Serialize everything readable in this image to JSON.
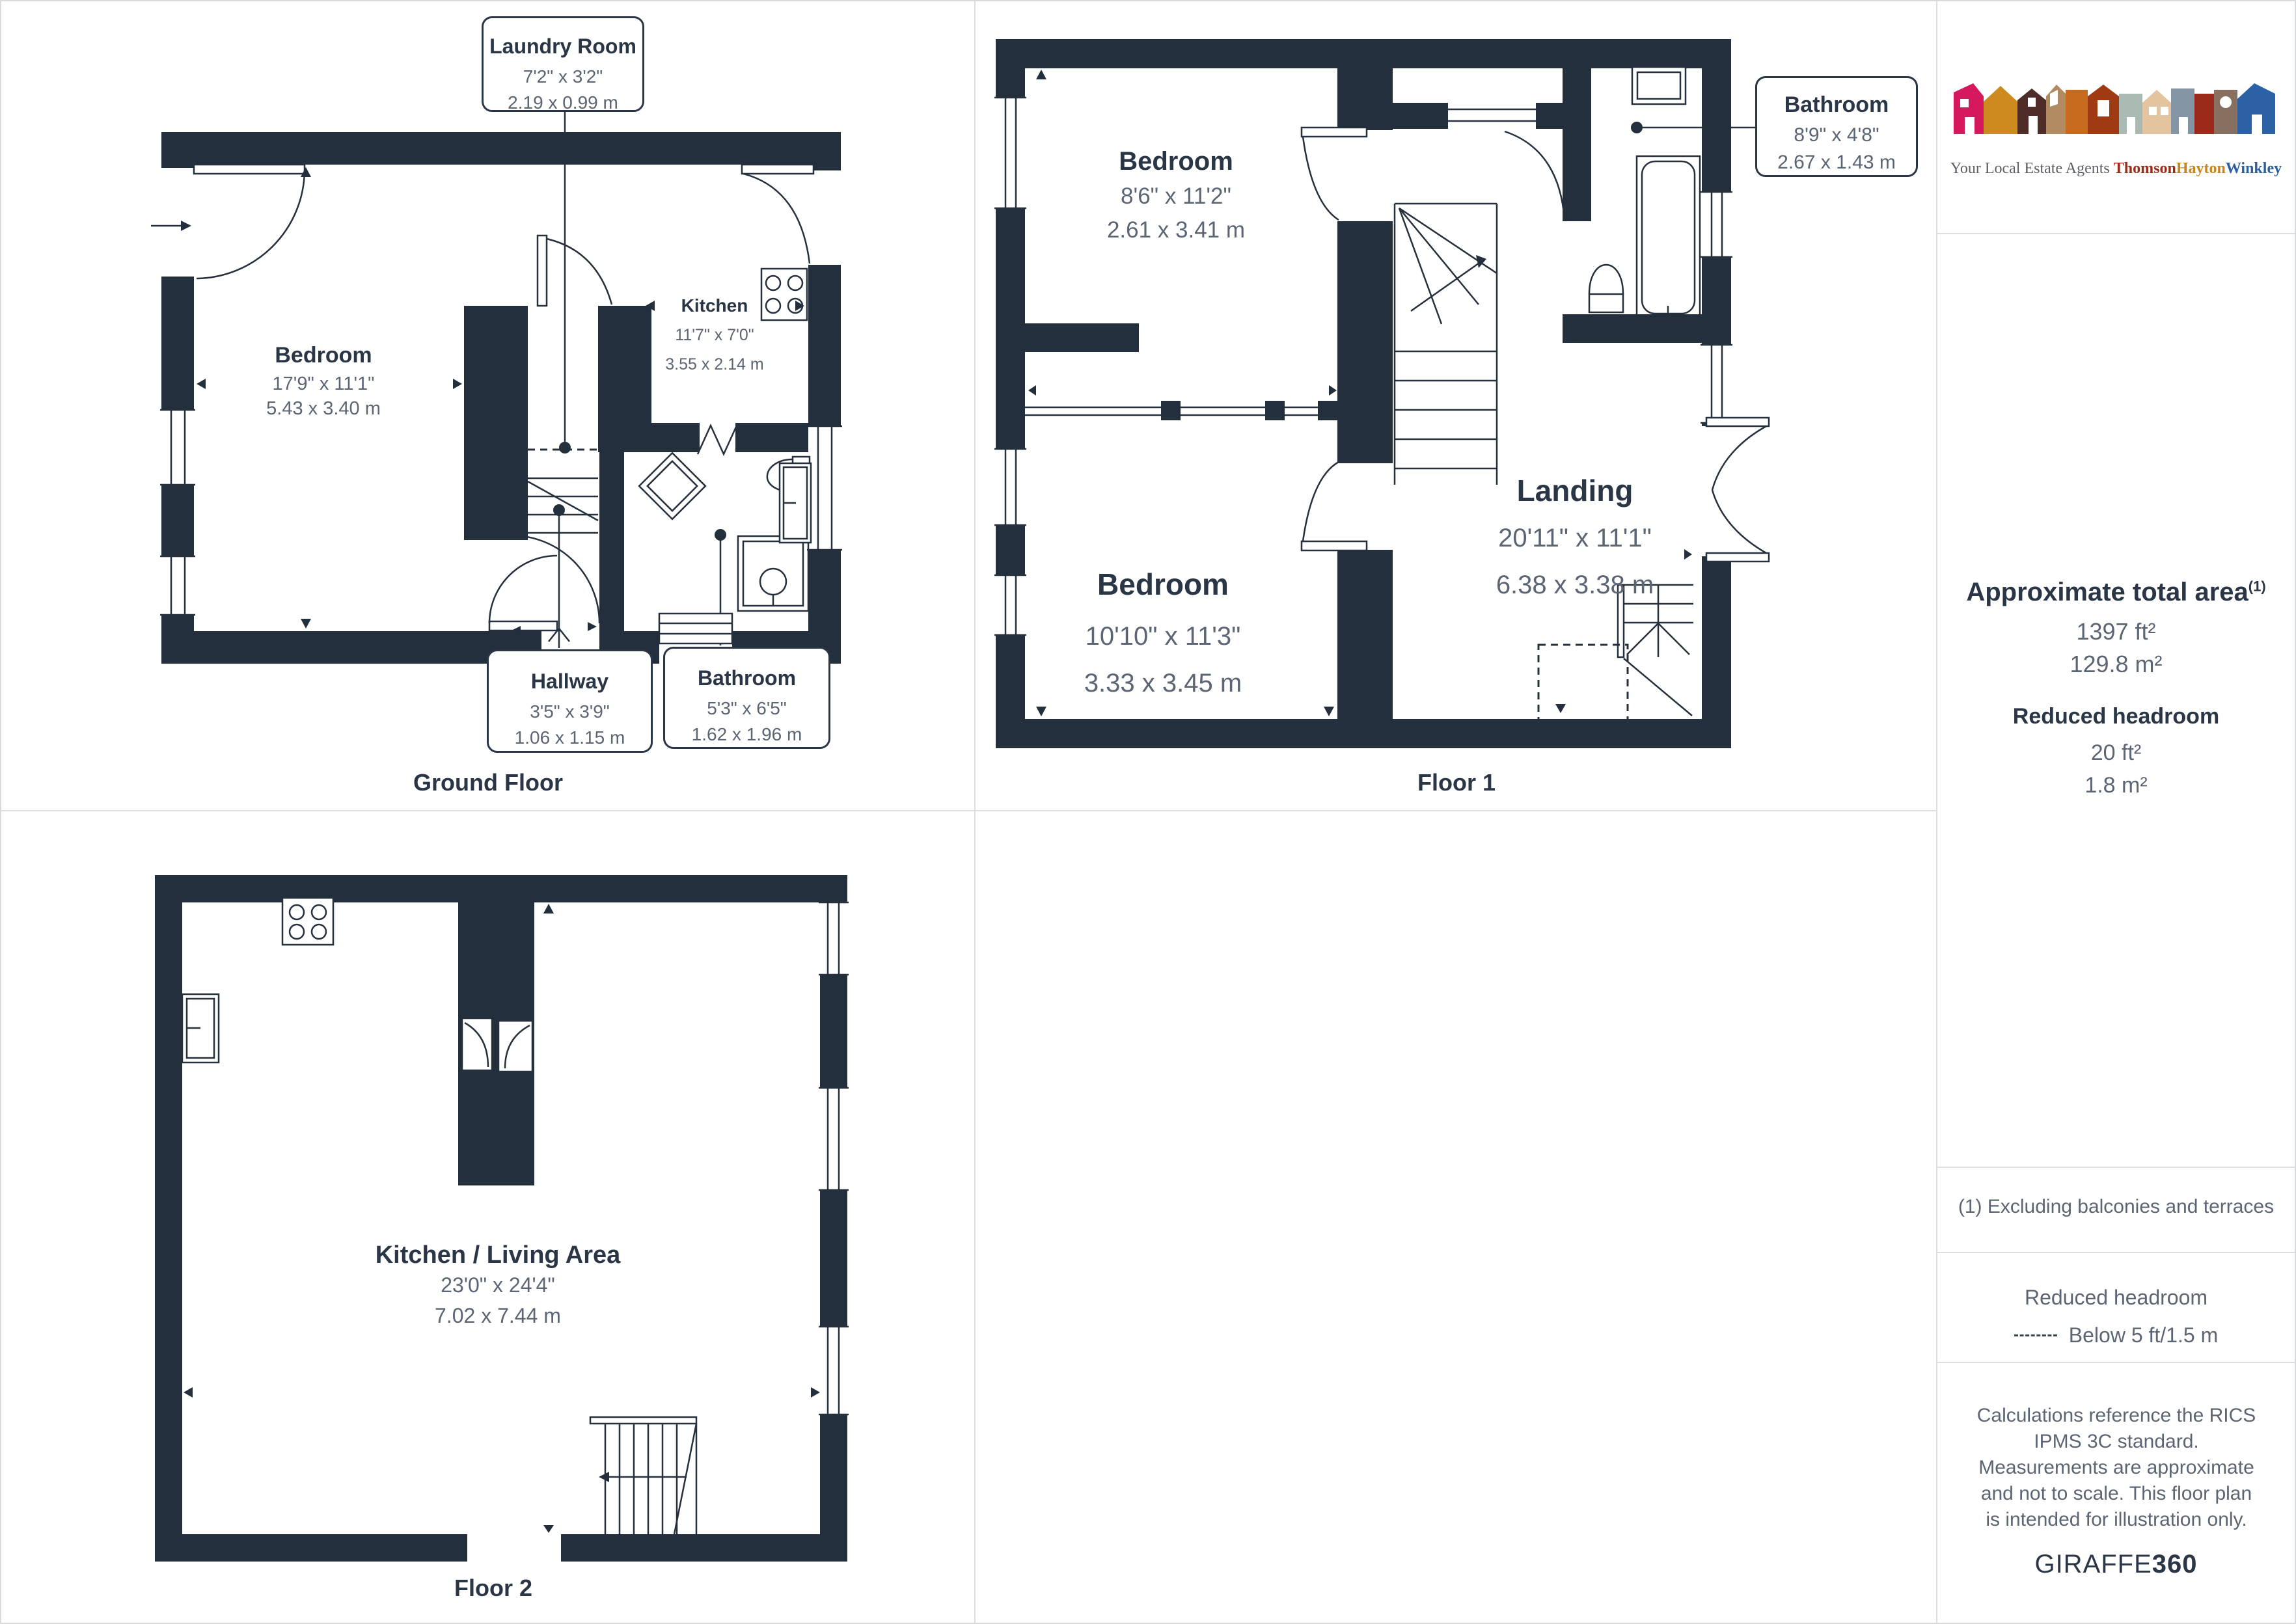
{
  "floors": [
    {
      "caption": "Ground Floor",
      "rooms": [
        {
          "name": "Bedroom",
          "ft": "17'9\" x 11'1\"",
          "m": "5.43 x 3.40 m"
        },
        {
          "name": "Kitchen",
          "ft": "11'7\" x 7'0\"",
          "m": "3.55 x 2.14 m"
        },
        {
          "name": "Laundry Room",
          "ft": "7'2\" x 3'2\"",
          "m": "2.19 x 0.99 m"
        },
        {
          "name": "Hallway",
          "ft": "3'5\" x 3'9\"",
          "m": "1.06 x 1.15 m"
        },
        {
          "name": "Bathroom",
          "ft": "5'3\" x 6'5\"",
          "m": "1.62 x 1.96 m"
        }
      ]
    },
    {
      "caption": "Floor 1",
      "rooms": [
        {
          "name": "Bedroom",
          "ft": "8'6\" x 11'2\"",
          "m": "2.61 x 3.41 m"
        },
        {
          "name": "Bedroom",
          "ft": "10'10\" x 11'3\"",
          "m": "3.33 x 3.45 m"
        },
        {
          "name": "Landing",
          "ft": "20'11\" x 11'1\"",
          "m": "6.38 x 3.38 m"
        },
        {
          "name": "Bathroom",
          "ft": "8'9\" x 4'8\"",
          "m": "2.67 x 1.43 m"
        }
      ]
    },
    {
      "caption": "Floor 2",
      "rooms": [
        {
          "name": "Kitchen / Living Area",
          "ft": "23'0\" x 24'4\"",
          "m": "7.02 x 7.44 m"
        }
      ]
    }
  ],
  "sidebar": {
    "total_area_label": "Approximate total area",
    "total_area_note_ref": "(1)",
    "total_area_ft": "1397 ft²",
    "total_area_m": "129.8 m²",
    "reduced_headroom_label": "Reduced headroom",
    "reduced_headroom_ft": "20 ft²",
    "reduced_headroom_m": "1.8 m²",
    "footnote": "(1) Excluding balconies and terraces",
    "legend_title": "Reduced headroom",
    "legend_item": "Below 5 ft/1.5 m",
    "disclaimer": "Calculations reference the RICS IPMS 3C standard. Measurements are approximate and not to scale. This floor plan is intended for illustration only."
  },
  "logo": {
    "tagline": "Your Local Estate Agents ",
    "words": [
      "Thomson",
      "Hayton",
      "Winkley"
    ],
    "word_colors": [
      "#9a2b1a",
      "#c8851d",
      "#2b5f9e"
    ],
    "house_colors": [
      "#d6195e",
      "#cd8a1e",
      "#4e2d29",
      "#b08a60",
      "#c66a1d",
      "#a03a13",
      "#a9bab3",
      "#e3c49f",
      "#8394a4",
      "#9c2a1b",
      "#87705f",
      "#2b62a5"
    ]
  },
  "provider": {
    "name": "GIRAFFE",
    "suffix": "360"
  },
  "colors": {
    "wall": "#232f3c",
    "label_text": "#2a3645",
    "dim_text": "#5b6573",
    "divider": "#dcdedf"
  }
}
